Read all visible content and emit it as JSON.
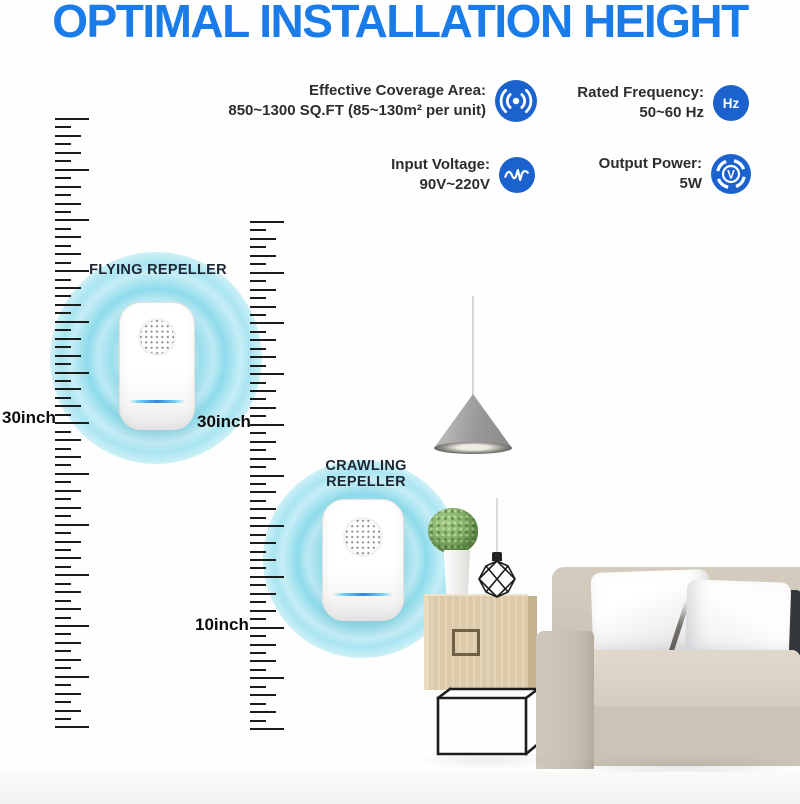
{
  "title": "OPTIMAL INSTALLATION HEIGHT",
  "specs": {
    "items": [
      {
        "id": "coverage",
        "label": "Effective Coverage Area:",
        "value": "850~1300 SQ.FT (85~130m² per unit)"
      },
      {
        "id": "frequency",
        "label": "Rated Frequency:",
        "value": "50~60 Hz",
        "icon_text": "Hz"
      },
      {
        "id": "voltage",
        "label": "Input Voltage:",
        "value": "90V~220V"
      },
      {
        "id": "power",
        "label": "Output Power:",
        "value": "5W",
        "icon_text": "V"
      }
    ]
  },
  "repellers": {
    "flying": {
      "label": "FLYING REPELLER",
      "height": "30inch"
    },
    "crawling": {
      "label": "CRAWLING REPELLER",
      "height": "10inch"
    }
  },
  "rulers": {
    "left": {
      "x": 55,
      "top": 118,
      "tick_count": 73,
      "spacing": 8.45
    },
    "right": {
      "x": 250,
      "top": 221,
      "tick_count": 61,
      "spacing": 8.45
    },
    "pattern_widths": [
      34,
      16,
      26,
      16,
      26,
      16
    ],
    "tick_height": 2,
    "color": "#1c1c1c"
  },
  "colors": {
    "title_blue": "#1a7ce8",
    "icon_blue": "#1b62cf",
    "glow_cyan": "#9fe2ef",
    "led_blue": "#2e86e0",
    "text_dark": "#2d2d2d",
    "sofa_beige": "#cbc4b6",
    "wood_tan": "#dccaa9",
    "plant_green": "#6fa055"
  }
}
